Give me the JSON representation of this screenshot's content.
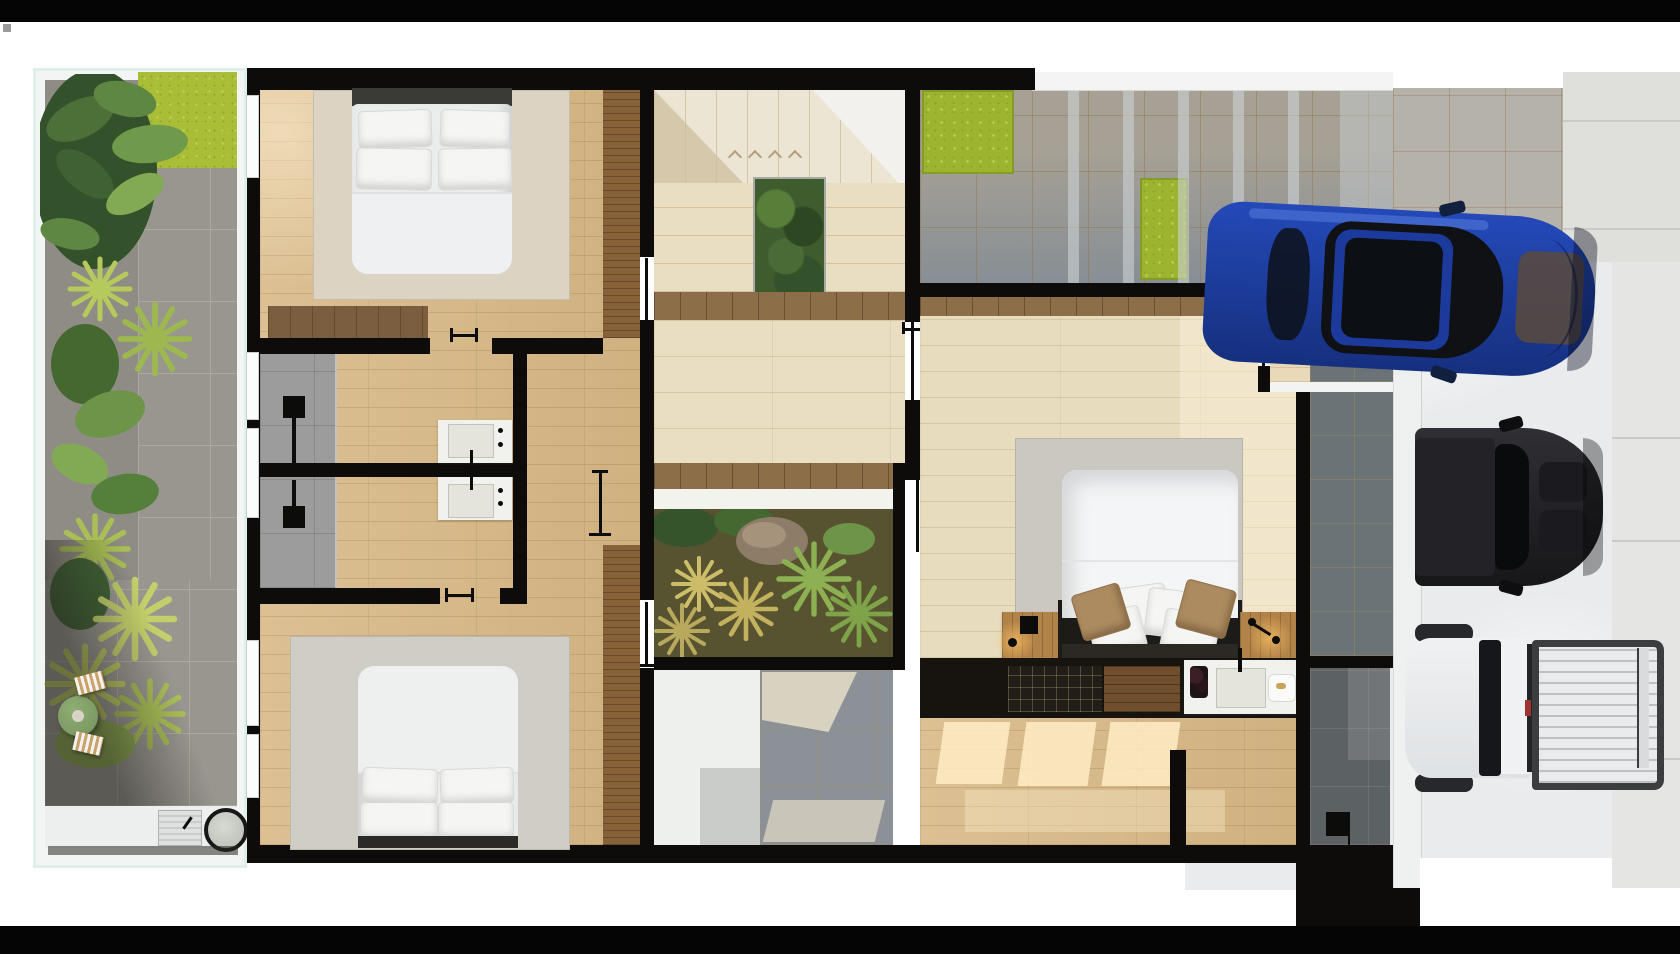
{
  "scene": {
    "type": "architectural-floor-plan-3d-render",
    "view": "top-down",
    "description": "Photorealistic top-down 3D render of a residential floor plan: tropical garden patio on the left, two bedrooms with shared bathrooms, central staircase with inner planted courtyard, master suite with wine console and bathroom, entry court, side path, and a driveway on the right with a blue sedan, a black car and a white pickup truck. Black letterbox bars frame the image top and bottom. No text is visible in the image."
  },
  "palette": {
    "frame_black": "#050505",
    "page_white": "#ffffff",
    "wall_black": "#0d0c0a",
    "wall_white": "#f3f5f4",
    "wood_floor": "#dcc093",
    "walnut": "#86613a",
    "travertine": "#e9ddc2",
    "sand_tile": "#e8dcbf",
    "landing_wood": "#8c6e49",
    "rug_beige": "#ddd3c3",
    "rug_gray": "#d0cdc6",
    "rug_master": "#cbc8c1",
    "duvet": "#eceeee",
    "pillow": "#f5f5f4",
    "pillow_tan": "#ac8b60",
    "headboard": "#3a3a36",
    "shower_tile": "#9b9c9b",
    "shower_dark": "#5c6163",
    "slate_path": "#6c7377",
    "paver_dark": "#878e95",
    "paver_light": "#b5b2aa",
    "garden_paver": "#999690",
    "sidewalk": "#dfdfdc",
    "concrete": "#eaebed",
    "grass": "#9db431",
    "moss": "#a9bd37",
    "plant_dark": "#33512a",
    "plant_mid": "#6d9447",
    "plant_light": "#9dbf63",
    "plant_yellow": "#b6c95c",
    "rock": "#8d7d68",
    "vanity_white": "#f1f1ee",
    "basin": "#e4e4dc",
    "console_black": "#17140f",
    "wine_rack": "#221d16",
    "shelf_wood": "#6f4f2d",
    "nightstand": "#b28349",
    "table_green": "#7c9a62",
    "car_blue": "#1d3da0",
    "car_black": "#26262a",
    "glass_dark": "#0f1114",
    "truck_white": "#e9ebed",
    "truck_rail": "#3b3d3f"
  },
  "inventory": {
    "rooms": [
      {
        "name": "garden-patio",
        "items": [
          "tropical-plants",
          "stone-pavers",
          "round-green-table",
          "two-striped-stools",
          "outdoor-sink",
          "barbecue-grill",
          "lime-moss-corner"
        ]
      },
      {
        "name": "bedroom-top",
        "items": [
          "double-bed-white",
          "four-pillows",
          "dark-headboard",
          "beige-rug",
          "walnut-wardrobe",
          "wood-dresser"
        ]
      },
      {
        "name": "bathroom-zone",
        "items": [
          "two-showers",
          "two-shower-heads",
          "two-vanity-sinks",
          "black-faucets",
          "clothes-stand"
        ]
      },
      {
        "name": "bedroom-bottom",
        "items": [
          "double-bed-white",
          "four-pillows",
          "gray-rug",
          "walnut-wardrobe"
        ]
      },
      {
        "name": "stair-hall",
        "items": [
          "staircase",
          "step-arrows",
          "green-wall-planter",
          "wood-landing",
          "travertine-floor"
        ]
      },
      {
        "name": "inner-courtyard",
        "items": [
          "wood-bench",
          "ornamental-grasses",
          "palm",
          "rock"
        ]
      },
      {
        "name": "laundry-room",
        "items": [
          "white-floor"
        ]
      },
      {
        "name": "rear-patio",
        "items": [
          "gray-tiles",
          "sun-patches"
        ]
      },
      {
        "name": "master-bedroom",
        "items": [
          "king-bed",
          "tan-accent-pillows",
          "gray-rug",
          "two-nightstands",
          "two-bedside-lamps",
          "console-wall",
          "wine-rack",
          "wood-shelf",
          "vanity-sink",
          "tray"
        ]
      },
      {
        "name": "dressing-area",
        "items": [
          "wood-floor",
          "window-sun-patches"
        ]
      },
      {
        "name": "master-shower",
        "items": [
          "dark-gray-tiles",
          "shower-head"
        ]
      },
      {
        "name": "entry-court",
        "items": [
          "white-frame-wall",
          "beige-tiles",
          "slate-tiles"
        ]
      },
      {
        "name": "side-path",
        "items": [
          "slate-tiles"
        ]
      },
      {
        "name": "driveway",
        "items": [
          "gray-pavers",
          "two-lawn-patches",
          "carport-shade-stripes",
          "concrete-apron",
          "sidewalk"
        ]
      }
    ],
    "vehicles": [
      {
        "name": "blue-sedan",
        "color_key": "car_blue",
        "position": "top-right"
      },
      {
        "name": "black-car",
        "color_key": "car_black",
        "position": "middle-right"
      },
      {
        "name": "white-pickup-truck",
        "color_key": "truck_white",
        "position": "bottom-right"
      }
    ]
  }
}
